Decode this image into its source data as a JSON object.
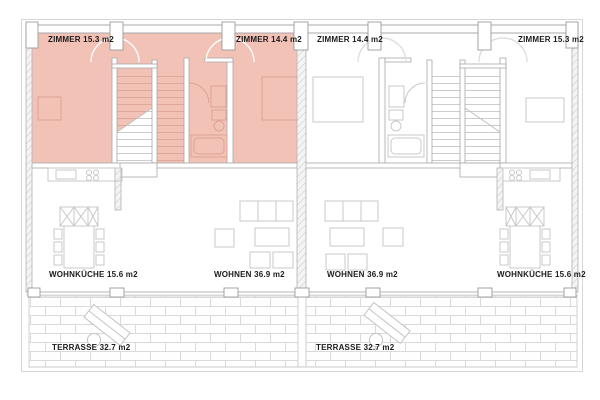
{
  "plan": {
    "type": "residential-floor-plan",
    "highlight_color": "#f2c2b7",
    "wall_line_color": "#a3a3a3",
    "furniture_line_color": "#c8c8c8",
    "highlight_furniture_line_color": "#dfa195",
    "units": {
      "left": {
        "highlighted": true,
        "rooms": {
          "zimmer_a": "ZIMMER 15.3 m2",
          "zimmer_b": "ZIMMER 14.4 m2",
          "wohnkueche": "WOHNKÜCHE 15.6 m2",
          "wohnen": "WOHNEN 36.9 m2",
          "terrasse": "TERRASSE 32.7 m2"
        }
      },
      "right": {
        "highlighted": false,
        "rooms": {
          "zimmer_a": "ZIMMER 14.4 m2",
          "zimmer_b": "ZIMMER 15.3 m2",
          "wohnen": "WOHNEN 36.9 m2",
          "wohnkueche": "WOHNKÜCHE 15.6 m2",
          "terrasse": "TERRASSE 32.7 m2"
        }
      }
    }
  }
}
